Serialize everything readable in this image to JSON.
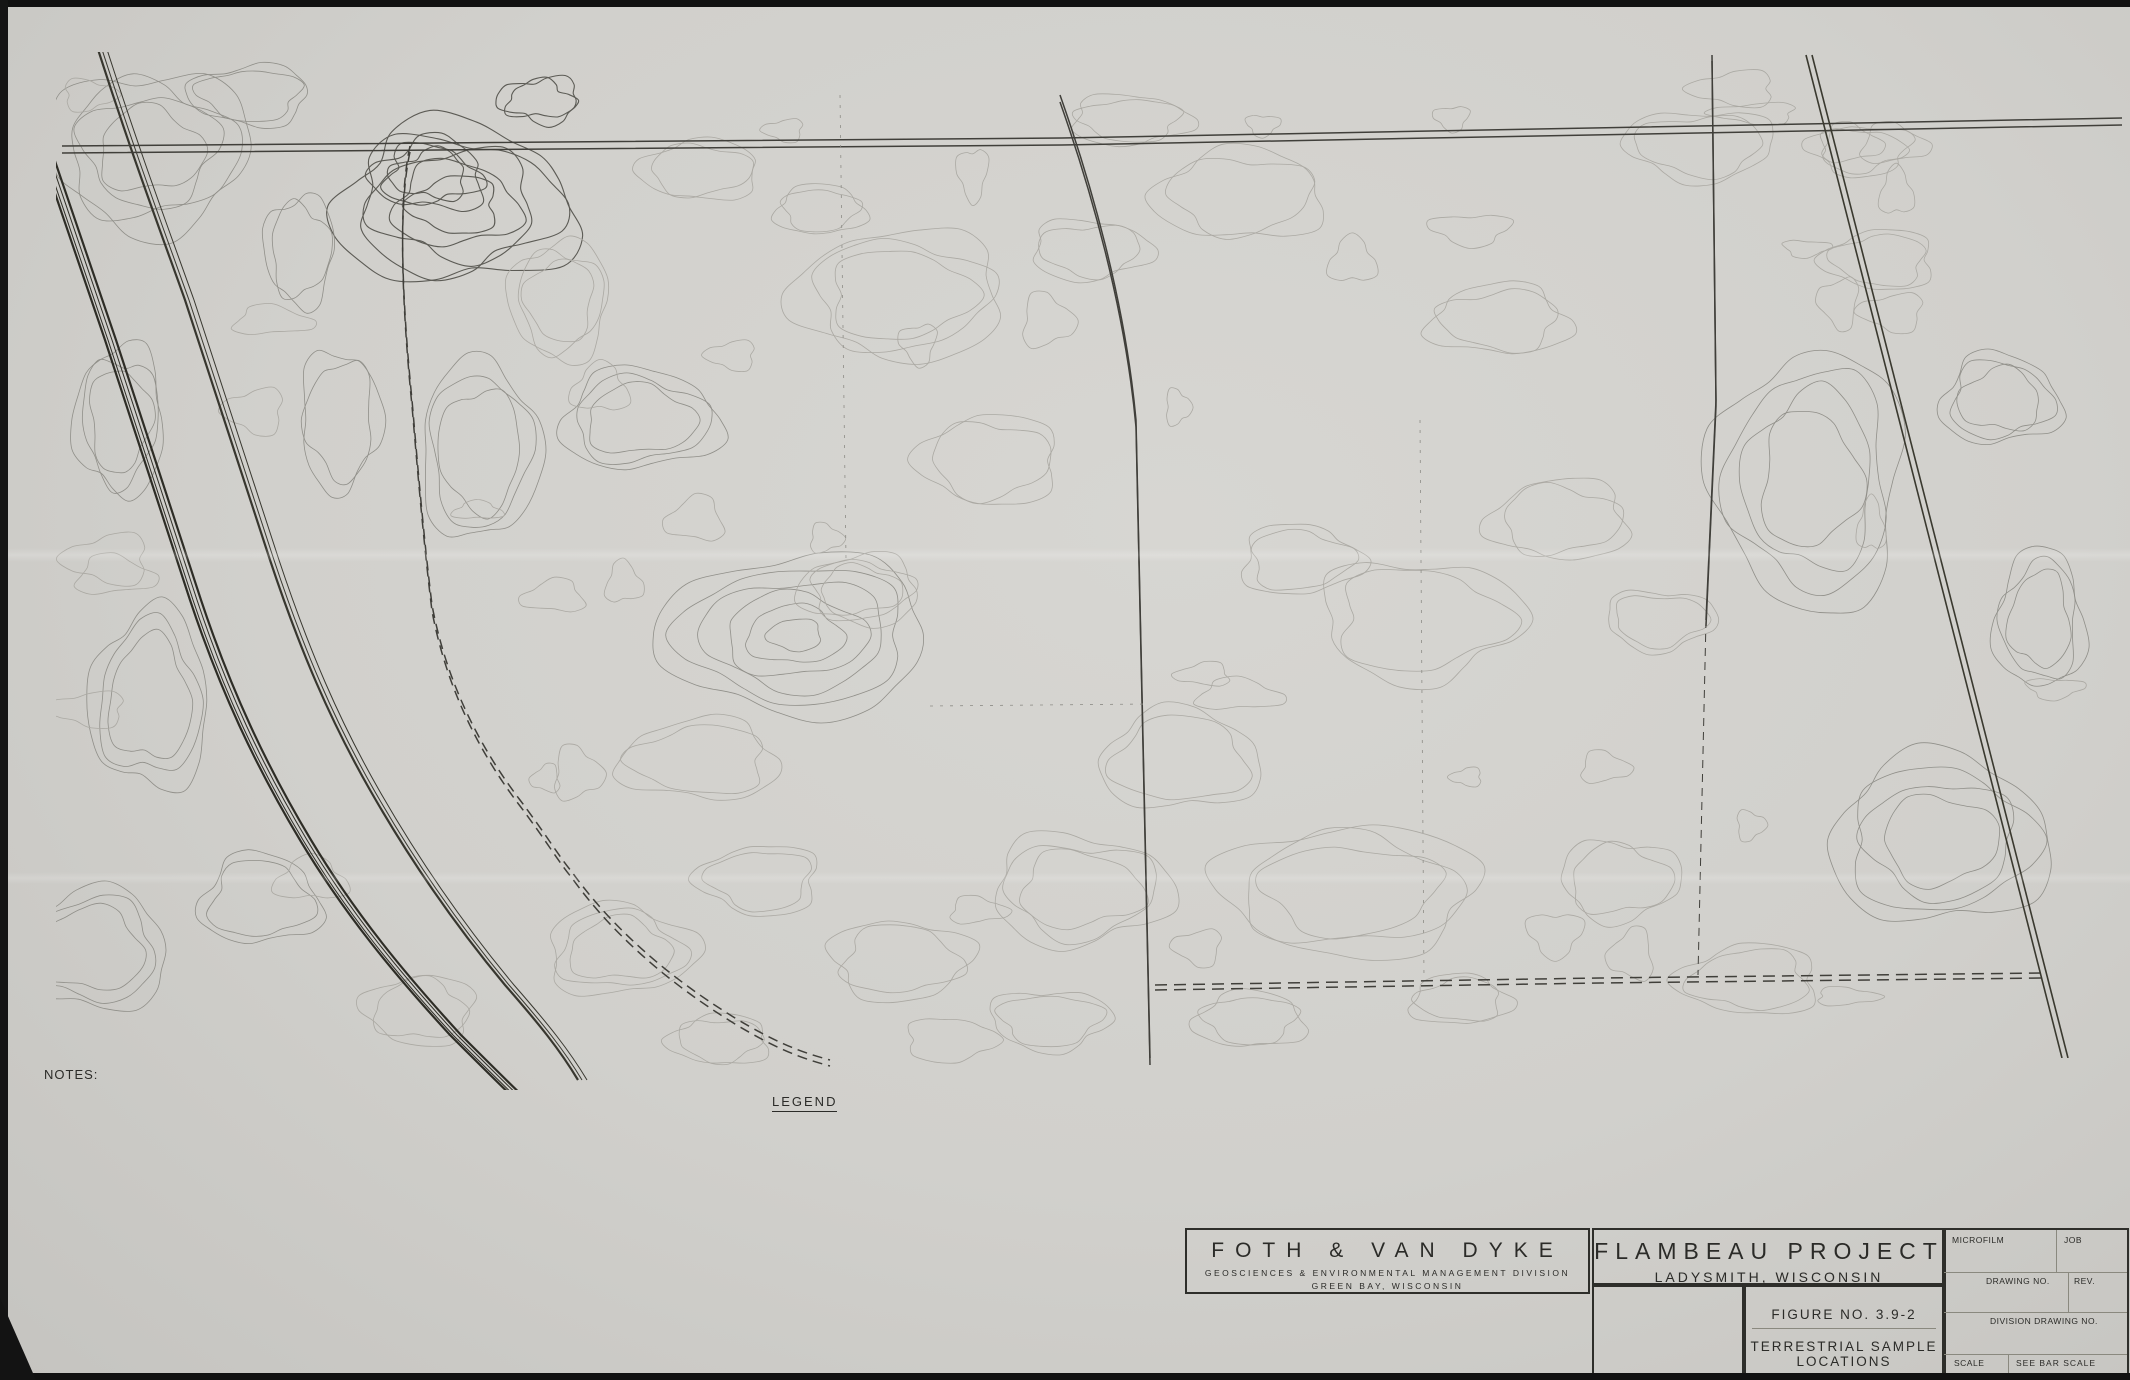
{
  "colors": {
    "paper": "#d1d0cc",
    "ink": "#2b2b28",
    "contour_light": "#a8a7a1",
    "contour_mid": "#8d8c86",
    "contour_dark": "#5c5b55",
    "route": "#1d1d1b"
  },
  "top_coordinates": [
    {
      "label": "37000 E",
      "x": 140
    },
    {
      "label": "38000 E",
      "x": 364
    },
    {
      "label": "39000 E",
      "x": 588
    },
    {
      "label": "40000 E",
      "x": 811
    },
    {
      "label": "41000 E",
      "x": 1035
    },
    {
      "label": "42000 E",
      "x": 1259
    },
    {
      "label": "43000 E",
      "x": 1483
    },
    {
      "label": "44000 E",
      "x": 1706
    },
    {
      "label": "45000 E",
      "x": 1930
    }
  ],
  "right_coordinates": [
    {
      "label": "43000 N",
      "y": 158
    },
    {
      "label": "42000 N",
      "y": 372
    },
    {
      "label": "41000 N",
      "y": 587
    },
    {
      "label": "40000 N",
      "y": 801
    },
    {
      "label": "39000 N",
      "y": 1016
    }
  ],
  "map_labels": [
    {
      "text": "BLACKBERRY LANE",
      "x": 950,
      "y": 131,
      "r": 0,
      "s": 12.5,
      "ls": 1.5
    },
    {
      "text": "DOUGHTY ROAD",
      "x": 1297,
      "y": 121,
      "r": 0,
      "s": 12.5,
      "ls": 1.5
    },
    {
      "text": "KENNECOTT DRIVE",
      "x": 401,
      "y": 352,
      "r": 84,
      "s": 12,
      "ls": 1.5
    },
    {
      "text": "FLAMBEAU RIVER",
      "x": 300,
      "y": 525,
      "r": 73,
      "s": 13,
      "ls": 3
    },
    {
      "text": "S.T.H. 27",
      "x": 1154,
      "y": 560,
      "r": 90,
      "s": 12,
      "ls": 1.5
    },
    {
      "text": "MEADOWBROOK LANE",
      "x": 1696,
      "y": 352,
      "r": 88,
      "s": 11,
      "ls": 1
    },
    {
      "text": "WISCONSIN CENTRAL LIMITED RAILROAD",
      "x": 1952,
      "y": 618,
      "r": 74,
      "s": 11,
      "ls": 1.5
    },
    {
      "text": "BIRD ROUTE 2",
      "x": 1277,
      "y": 447,
      "r": -4,
      "s": 13.5,
      "ls": 4
    },
    {
      "text": "BIRD ROUTE 1",
      "x": 818,
      "y": 672,
      "r": -28,
      "s": 13.5,
      "ls": 4
    },
    {
      "text": "BIRD ROUTE 4",
      "x": 536,
      "y": 713,
      "r": 60,
      "s": 13.5,
      "ls": 4
    },
    {
      "text": "BIRD ROUTE 3",
      "x": 458,
      "y": 720,
      "r": 57,
      "s": 13.5,
      "ls": 4
    },
    {
      "text": "BIRD ROUTE 5",
      "x": 1652,
      "y": 760,
      "r": 0,
      "s": 13.5,
      "ls": 4
    },
    {
      "text": "HANSEN ROAD",
      "x": 1572,
      "y": 966,
      "r": 0,
      "s": 11,
      "ls": 1.5
    }
  ],
  "contour_labels": [
    {
      "t": "1140",
      "x": 973,
      "y": 95,
      "r": -35
    },
    {
      "t": "1150",
      "x": 1040,
      "y": 129,
      "r": 8
    },
    {
      "t": "1150",
      "x": 2013,
      "y": 97,
      "r": 0
    },
    {
      "t": "1150",
      "x": 1873,
      "y": 127,
      "r": 0
    },
    {
      "t": "1090",
      "x": 287,
      "y": 282,
      "r": -55
    },
    {
      "t": "1110",
      "x": 418,
      "y": 290,
      "r": -72
    },
    {
      "t": "1120",
      "x": 493,
      "y": 280,
      "r": -35
    },
    {
      "t": "1110",
      "x": 440,
      "y": 402,
      "r": -20
    },
    {
      "t": "1100",
      "x": 408,
      "y": 560,
      "r": -78
    },
    {
      "t": "1090",
      "x": 322,
      "y": 708,
      "r": -10
    },
    {
      "t": "1140",
      "x": 768,
      "y": 585,
      "r": 10
    },
    {
      "t": "1130",
      "x": 658,
      "y": 633,
      "r": -75
    },
    {
      "t": "1150",
      "x": 910,
      "y": 632,
      "r": -15
    },
    {
      "t": "1140",
      "x": 948,
      "y": 480,
      "r": -70
    },
    {
      "t": "1150",
      "x": 1093,
      "y": 413,
      "r": 12
    },
    {
      "t": "1150",
      "x": 1523,
      "y": 465,
      "r": 10
    },
    {
      "t": "1160",
      "x": 1648,
      "y": 733,
      "r": -40
    },
    {
      "t": "1170",
      "x": 1783,
      "y": 868,
      "r": 8
    },
    {
      "t": "1170",
      "x": 1917,
      "y": 602,
      "r": -60
    },
    {
      "t": "1160",
      "x": 1902,
      "y": 692,
      "r": -50
    },
    {
      "t": "1150",
      "x": 1730,
      "y": 285,
      "r": 10
    },
    {
      "t": "1100",
      "x": 540,
      "y": 812,
      "r": 8
    },
    {
      "t": "1120",
      "x": 668,
      "y": 815,
      "r": -70
    },
    {
      "t": "1130",
      "x": 837,
      "y": 1070,
      "r": -28
    },
    {
      "t": "1140",
      "x": 757,
      "y": 1080,
      "r": 0
    },
    {
      "t": "1150",
      "x": 2040,
      "y": 115,
      "r": 0
    }
  ],
  "markers": {
    "circles": [
      {
        "label": "C",
        "x": 535,
        "y": 532
      },
      {
        "label": "2",
        "x": 519,
        "y": 641
      },
      {
        "label": "B",
        "x": 562,
        "y": 632
      },
      {
        "label": "1A",
        "x": 642,
        "y": 567
      },
      {
        "label": "1A",
        "x": 699,
        "y": 503
      },
      {
        "label": "2A",
        "x": 434,
        "y": 702
      },
      {
        "label": "5",
        "x": 583,
        "y": 688
      },
      {
        "label": "1",
        "x": 612,
        "y": 714
      },
      {
        "label": "A",
        "x": 602,
        "y": 748
      },
      {
        "label": "3",
        "x": 567,
        "y": 841
      },
      {
        "label": "4",
        "x": 622,
        "y": 836
      }
    ],
    "triangles": [
      {
        "label": "2",
        "x": 553,
        "y": 603
      },
      {
        "label": "1",
        "x": 904,
        "y": 578
      },
      {
        "label": "3",
        "x": 590,
        "y": 725
      }
    ],
    "hexagons": [
      {
        "label": "1",
        "x": 1072,
        "y": 737
      },
      {
        "label": "2",
        "x": 1539,
        "y": 977
      },
      {
        "label": "3",
        "x": 1670,
        "y": 978
      },
      {
        "label": "4",
        "x": 1704,
        "y": 365
      }
    ],
    "areas": [
      {
        "label": "A",
        "points": "754,534 871,511 879,549 761,573",
        "lx": 810,
        "ly": 546
      },
      {
        "label": "B",
        "points": "550,687 598,662 652,760 605,783",
        "lx": 624,
        "ly": 757
      },
      {
        "label": "C",
        "points": "988,643 1055,643 1052,800 985,798",
        "lx": 1018,
        "ly": 735
      }
    ]
  },
  "legend": {
    "title": "LEGEND",
    "left": [
      {
        "sym": "contour",
        "sym_text": "1100",
        "label": "EXISTING CONTOUR"
      },
      {
        "sym": "paved",
        "label": "EXISTING PAVED ROADWAY"
      },
      {
        "sym": "trail",
        "label": "EXISTING TRAIL/GRAVEL SURFACE"
      },
      {
        "sym": "trees",
        "label": "TREES AND/OR BRUSH"
      },
      {
        "sym": "fence",
        "label": "FENCE"
      },
      {
        "sym": "monument",
        "sym_text": "F-1",
        "label": "CONTROL MONUMENT"
      }
    ],
    "right": [
      {
        "sym": "circle",
        "sym_text": "B",
        "label": "SOIL SAMPLE LOCATIONS"
      },
      {
        "sym": "circle",
        "sym_text": "3",
        "label": "VEGETATION SAMPLE LOCATIONS"
      },
      {
        "sym": "triangle",
        "sym_text": "2",
        "label": "SOIL INVERTEBRATE LOCATIONS"
      },
      {
        "sym": "hexagon",
        "sym_text": "1",
        "label": "ANURAN VOICE SURVEY POINTS"
      },
      {
        "sym": "rect",
        "sym_text": "C",
        "label": "SMALL MAMMAL TRAPPING AREAS"
      },
      {
        "sym": "dashes",
        "label": "BIRD OBSERVATION ROUTES"
      }
    ]
  },
  "notes": {
    "title": "NOTES:",
    "items": [
      {
        "num": "1.",
        "lines": [
          "SITE LOCATION: SECTIONS 9, 10, 15 & 16, T34N, R6W, RUSK COUNTY, WISCONSIN."
        ]
      },
      {
        "num": "2.",
        "lines": [
          "TOPOGRAPHIC BASE MAP PREPARED FROM AERIAL SURVEY BY SURDEX CORPORATION,",
          "CHESTERFIELD, MISSOURI. DATE OF PHOTOGRAPHY - APRIL 24, 1970.",
          "ROADS, TREES AND BUILDINGS WERE UPDATED AS PER AERIAL PHOTOGRAPH",
          "TAKEN BY MARKHURD CORPORATON, MINNEAPOLIS, MINNESOTA.",
          "DATE OF PHOTOGRAPHY - SEPTEMBER 14, 1987."
        ]
      },
      {
        "num": "3.",
        "lines": [
          "ELEVATIONS BASED ON MEAN SEA LEVEL DATUM.",
          "CONTOUR INTERVAL IS TWO FEET."
        ]
      },
      {
        "num": "4.",
        "lines": [
          "HORIZONTAL DATUM BASED ON PROJECT SITE GRID SYSTEM. SITE GRID",
          "COORDINATES CORRELATION TO STATE PLANE COORDINATES DERIVED AS FOLLOWS:"
        ]
      }
    ],
    "grid_table": {
      "col1_header": [
        "SITE GRID COORDINATES",
        "CONTROL MONUMENT F-1"
      ],
      "col2_header": [
        "STATE PLANE",
        "COORDINATES"
      ],
      "rows": [
        [
          "40000 N =",
          "587,357.8087 N"
        ],
        [
          "40000 E =",
          "1,713,516.1229 E"
        ]
      ]
    },
    "footer": [
      "THE ANGULAR ROTATION FROM STATE PLANE BEARINGS TO SITE GRID",
      "BEARINGS IS 359°-13'-23\" RIGHT WITH CONTROL POINT F-1 AS THE BASE POINT."
    ]
  },
  "north_label": "N",
  "scale_bar": {
    "ticks": [
      "0",
      "300'",
      "600'"
    ],
    "label": "SCALE"
  },
  "tables": {
    "references": {
      "side": "REFERENCES",
      "headers": [
        "DWG. NO.",
        "DESCRIPTION"
      ]
    },
    "revisions": {
      "headers": [
        "NO.",
        "DATE",
        "REVISIONS",
        "BY",
        "CHK'D",
        "ENG'R",
        "ENG'R MGR."
      ]
    },
    "signoff": {
      "by": "BY",
      "date": "DATE",
      "left_rows": [
        "PROJ. ENG'R",
        "MGR. PROCESS ENG'R",
        "ENG'R MGR."
      ],
      "right_rows": [
        {
          "label": "DESIGN",
          "by": "",
          "date": ""
        },
        {
          "label": "DRAWN",
          "by": "MJO",
          "date": "3/89"
        },
        {
          "label": "CHK'D",
          "by": "TJW",
          "date": "3-89"
        },
        {
          "label": "DES. ENG'R",
          "by": "",
          "date": ""
        },
        {
          "label": "SECT. ENG'R",
          "by": "",
          "date": ""
        }
      ]
    }
  },
  "firm": {
    "name": "FOTH  &  VAN  DYKE",
    "division": "GEOSCIENCES & ENVIRONMENTAL MANAGEMENT DIVISION",
    "location": "GREEN BAY, WISCONSIN"
  },
  "project": {
    "title": "FLAMBEAU PROJECT",
    "city": "LADYSMITH, WISCONSIN",
    "company_lines": [
      "KENNECOTT",
      "MINERALS",
      "COMPANY"
    ],
    "address_lines": [
      "1515 MINERAL SQUARE",
      "SALT LAKE CITY, UTAH",
      "84112"
    ],
    "figure": "FIGURE NO. 3.9-2",
    "figure_title": "TERRESTRIAL SAMPLE LOCATIONS"
  },
  "stamp": {
    "microfilm": "MICROFILM",
    "job": "JOB",
    "drawing_no": "DRAWING NO.",
    "rev": "REV.",
    "division_drawing_no": "DIVISION DRAWING NO.",
    "scale_label": "SCALE",
    "scale_value": "SEE BAR SCALE"
  }
}
